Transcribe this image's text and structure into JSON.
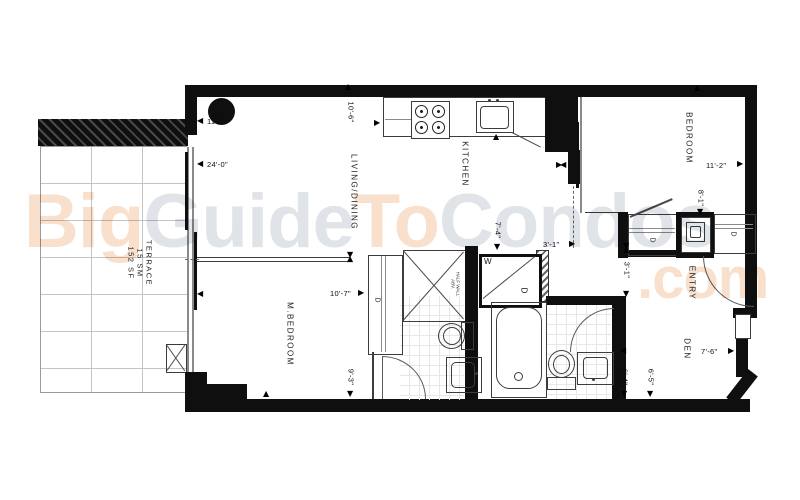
{
  "watermark": {
    "big": "Big",
    "guide": "Guide",
    "to": "To",
    "condos": "Condos",
    "com": ".com",
    "orange": "#f4c7a3",
    "gray": "#c7ccd4"
  },
  "rooms": {
    "terrace": {
      "label": "TERRACE",
      "area_sm": "15 SM",
      "area_sf": "152 SF"
    },
    "living_dining": {
      "label": "LIVING/DINING"
    },
    "kitchen": {
      "label": "KITCHEN"
    },
    "bedroom": {
      "label": "BEDROOM"
    },
    "master_bedroom": {
      "label": "M.BEDROOM"
    },
    "entry": {
      "label": "ENTRY"
    },
    "den": {
      "label": "DEN"
    }
  },
  "dimensions": {
    "terrace_width": "11'-7\"",
    "terrace_length": "24'-0\"",
    "kitchen_depth": "10'-6\"",
    "bedroom_width": "11'-2\"",
    "bedroom_closet": "8'-1\"",
    "hall_depth": "7'-4\"",
    "hall_width": "3'-1\"",
    "closet_width": "3'-1\"",
    "master_width": "10'-7\"",
    "master_depth": "9'-3\"",
    "bath_depth": "6'-4\"",
    "den_depth": "6'-5\"",
    "den_width": "7'-6\""
  },
  "fixtures": {
    "washer": "W",
    "dryer": "D",
    "closet": "D"
  },
  "annotations": {
    "half_wall_1": "HALF WALL",
    "half_wall_2": "ABV."
  },
  "colors": {
    "wall": "#0f0f0f",
    "line": "#3c3c3c",
    "watermark_orange": "#f4c7a3",
    "watermark_gray": "#c7ccd4"
  }
}
